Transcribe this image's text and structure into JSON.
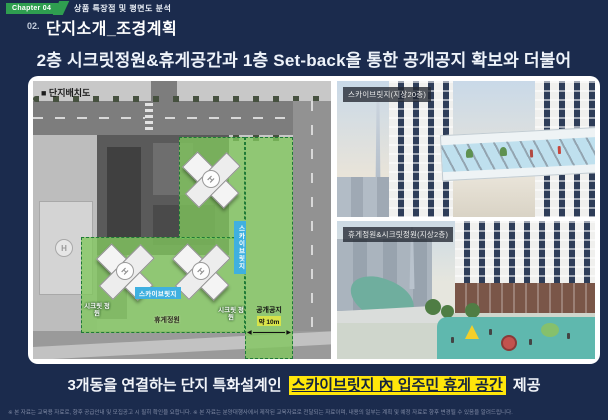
{
  "colors": {
    "background": "#1b2b4d",
    "accent_green": "#2f9e50",
    "highlight_yellow": "#ffe60a",
    "label_blue": "#3fb0e0",
    "overlay_green": "#80c65c"
  },
  "header": {
    "chapter_badge": "Chapter 04",
    "chapter_title": "상품 특장점 및 평면도 분석",
    "section_number": "02.",
    "page_title": "단지소개_조경계획"
  },
  "headline_top": "2층 시크릿정원&휴게공간과 1층 Set-back을 통한 공개공지 확보와 더불어",
  "site_plan": {
    "title": "■ 단지배치도",
    "labels": {
      "sky_bridge": "스카이브릿지",
      "rest_garden": "휴게정원",
      "secret_garden": "시크릿 정원",
      "open_space": "공개공지",
      "open_space_width": "약 10m",
      "helipad": "H",
      "arrow_left": "◀",
      "arrow_right": "▶"
    }
  },
  "renderings": {
    "sky_bridge": {
      "caption": "스카이브릿지(지상20층)"
    },
    "garden": {
      "caption": "휴게정원&시크릿정원(지상2층)"
    }
  },
  "headline_bottom": {
    "prefix": "3개동을 연결하는 단지 특화설계인",
    "highlight": "스카이브릿지 內 입주민 휴게 공간",
    "suffix": "제공"
  },
  "footer": {
    "disclaimer": "※ 본 자료는 교육용 자료로, 향후 공급안내 및 모집공고 시 필히 확인을 요합니다. ※ 본 자료는 분양대행사에서 제작된 교육자료로 전달되는 자료이며, 내용의 일부는 계획 및 예정 자료로 향후 변경될 수 있음을 알려드립니다."
  }
}
